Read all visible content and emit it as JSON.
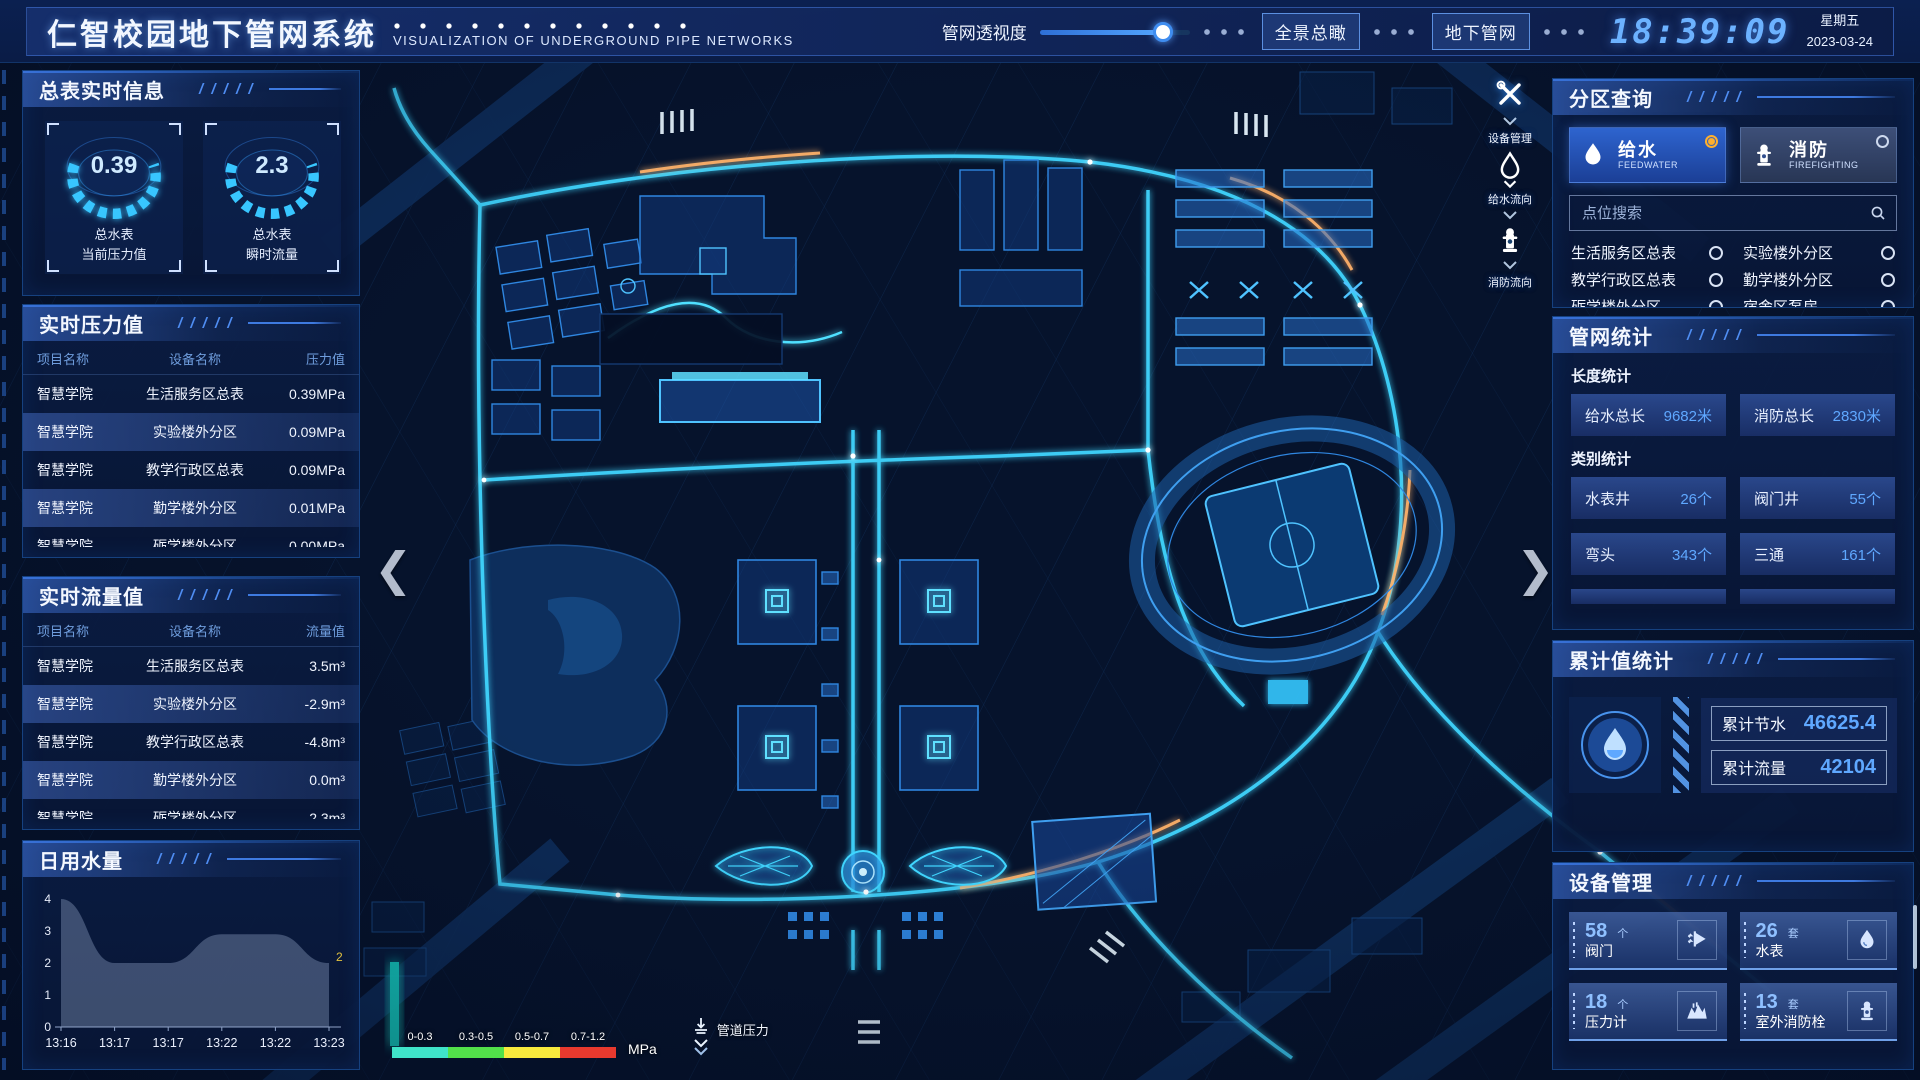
{
  "header": {
    "title": "仁智校园地下管网系统",
    "subtitle": "VISUALIZATION OF UNDERGROUND PIPE NETWORKS",
    "slider_label": "管网透视度",
    "slider_percent": 82,
    "btn_overview": "全景总瞰",
    "btn_underground": "地下管网",
    "time": "18:39:09",
    "weekday": "星期五",
    "date": "2023-03-24"
  },
  "left": {
    "panel_meters": {
      "title": "总表实时信息",
      "gauges": [
        {
          "value": "0.39",
          "label1": "总水表",
          "label2": "当前压力值"
        },
        {
          "value": "2.3",
          "label1": "总水表",
          "label2": "瞬时流量"
        }
      ]
    },
    "panel_pressure": {
      "title": "实时压力值",
      "columns": [
        "项目名称",
        "设备名称",
        "压力值"
      ],
      "rows": [
        [
          "智慧学院",
          "生活服务区总表",
          "0.39MPa"
        ],
        [
          "智慧学院",
          "实验楼外分区",
          "0.09MPa"
        ],
        [
          "智慧学院",
          "教学行政区总表",
          "0.09MPa"
        ],
        [
          "智慧学院",
          "勤学楼外分区",
          "0.01MPa"
        ],
        [
          "智慧学院",
          "砺学楼外分区",
          "0.00MPa"
        ]
      ]
    },
    "panel_flow": {
      "title": "实时流量值",
      "columns": [
        "项目名称",
        "设备名称",
        "流量值"
      ],
      "rows": [
        [
          "智慧学院",
          "生活服务区总表",
          "3.5m³"
        ],
        [
          "智慧学院",
          "实验楼外分区",
          "-2.9m³"
        ],
        [
          "智慧学院",
          "教学行政区总表",
          "-4.8m³"
        ],
        [
          "智慧学院",
          "勤学楼外分区",
          "0.0m³"
        ],
        [
          "智慧学院",
          "砺学楼外分区",
          "2.3m³"
        ]
      ]
    },
    "panel_daily": {
      "title": "日用水量"
    }
  },
  "chart_data": {
    "type": "area",
    "title": "日用水量",
    "x": [
      "13:16",
      "13:17",
      "13:17",
      "13:22",
      "13:22",
      "13:23"
    ],
    "values": [
      4,
      2,
      2,
      2.9,
      2.9,
      2
    ],
    "xlabel": "",
    "ylabel": "",
    "ylim": [
      0,
      4
    ],
    "yticks": [
      0,
      1,
      2,
      3,
      4
    ],
    "end_label": "2",
    "grid": false,
    "legend_position": "none",
    "area_color": "#93a6c9"
  },
  "map": {
    "toolbar": [
      {
        "icon": "tools-icon",
        "label": "设备管理"
      },
      {
        "icon": "water-drop-icon",
        "label": "给水流向"
      },
      {
        "icon": "hydrant-icon",
        "label": "消防流向"
      }
    ],
    "legend": {
      "segments": [
        {
          "range": "0-0.3",
          "color": "#3fe3c9"
        },
        {
          "range": "0.3-0.5",
          "color": "#52e04a"
        },
        {
          "range": "0.5-0.7",
          "color": "#f7e93d"
        },
        {
          "range": "0.7-1.2",
          "color": "#e8392e"
        }
      ],
      "unit": "MPa",
      "label": "管道压力"
    }
  },
  "right": {
    "panel_query": {
      "title": "分区查询",
      "tabs": [
        {
          "label": "给水",
          "sub": "FEEDWATER",
          "icon": "water-drop-icon",
          "selected": true
        },
        {
          "label": "消防",
          "sub": "FIREFIGHTING",
          "icon": "hydrant-icon",
          "selected": false
        }
      ],
      "search_placeholder": "点位搜索",
      "items": [
        "生活服务区总表",
        "实验楼外分区",
        "教学行政区总表",
        "勤学楼外分区",
        "砺学楼外分区",
        "宿舍区泵房"
      ]
    },
    "panel_stats": {
      "title": "管网统计",
      "len_title": "长度统计",
      "len_stats": [
        {
          "label": "给水总长",
          "value": "9682米"
        },
        {
          "label": "消防总长",
          "value": "2830米"
        }
      ],
      "cat_title": "类别统计",
      "cat_stats": [
        {
          "label": "水表井",
          "value": "26个"
        },
        {
          "label": "阀门井",
          "value": "55个"
        },
        {
          "label": "弯头",
          "value": "343个"
        },
        {
          "label": "三通",
          "value": "161个"
        }
      ]
    },
    "panel_total": {
      "title": "累计值统计",
      "stats": [
        {
          "label": "累计节水",
          "value": "46625.4"
        },
        {
          "label": "累计流量",
          "value": "42104"
        }
      ]
    },
    "panel_devices": {
      "title": "设备管理",
      "items": [
        {
          "count": "58",
          "unit": "个",
          "label": "阀门",
          "icon": "valve-icon"
        },
        {
          "count": "26",
          "unit": "套",
          "label": "水表",
          "icon": "water-drop-icon"
        },
        {
          "count": "18",
          "unit": "个",
          "label": "压力计",
          "icon": "pressure-gauge-icon"
        },
        {
          "count": "13",
          "unit": "套",
          "label": "室外消防栓",
          "icon": "hydrant-icon"
        }
      ]
    }
  }
}
